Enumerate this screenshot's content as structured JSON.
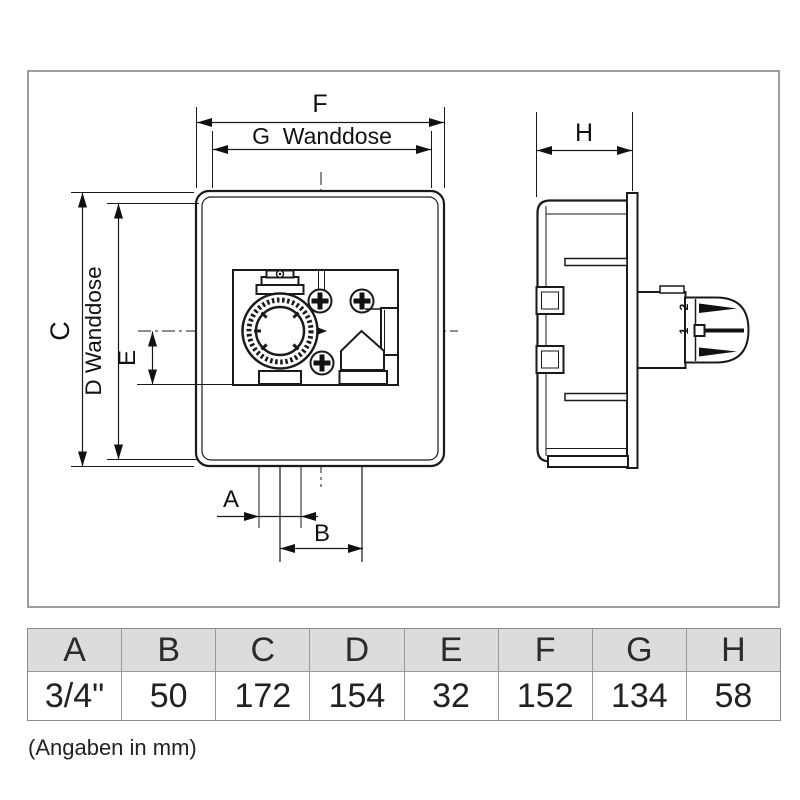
{
  "front_view": {
    "labels": {
      "f": "F",
      "g": "G  Wanddose",
      "c": "C",
      "d": "D Wanddose",
      "e": "E",
      "a": "A",
      "b": "B"
    }
  },
  "side_view": {
    "labels": {
      "h": "H"
    },
    "knob": {
      "mark_top": "2",
      "mark_bottom": "1"
    }
  },
  "dimension_table": {
    "headers": [
      "A",
      "B",
      "C",
      "D",
      "E",
      "F",
      "G",
      "H"
    ],
    "values": [
      "3/4\"",
      "50",
      "172",
      "154",
      "32",
      "152",
      "134",
      "58"
    ]
  },
  "footnote": "(Angaben in mm)",
  "colors": {
    "line": "#1a1a1a",
    "frame_border": "#9e9e9e",
    "table_header_bg": "#dcdcdc",
    "table_border": "#8c8c8c",
    "text": "#222222"
  }
}
